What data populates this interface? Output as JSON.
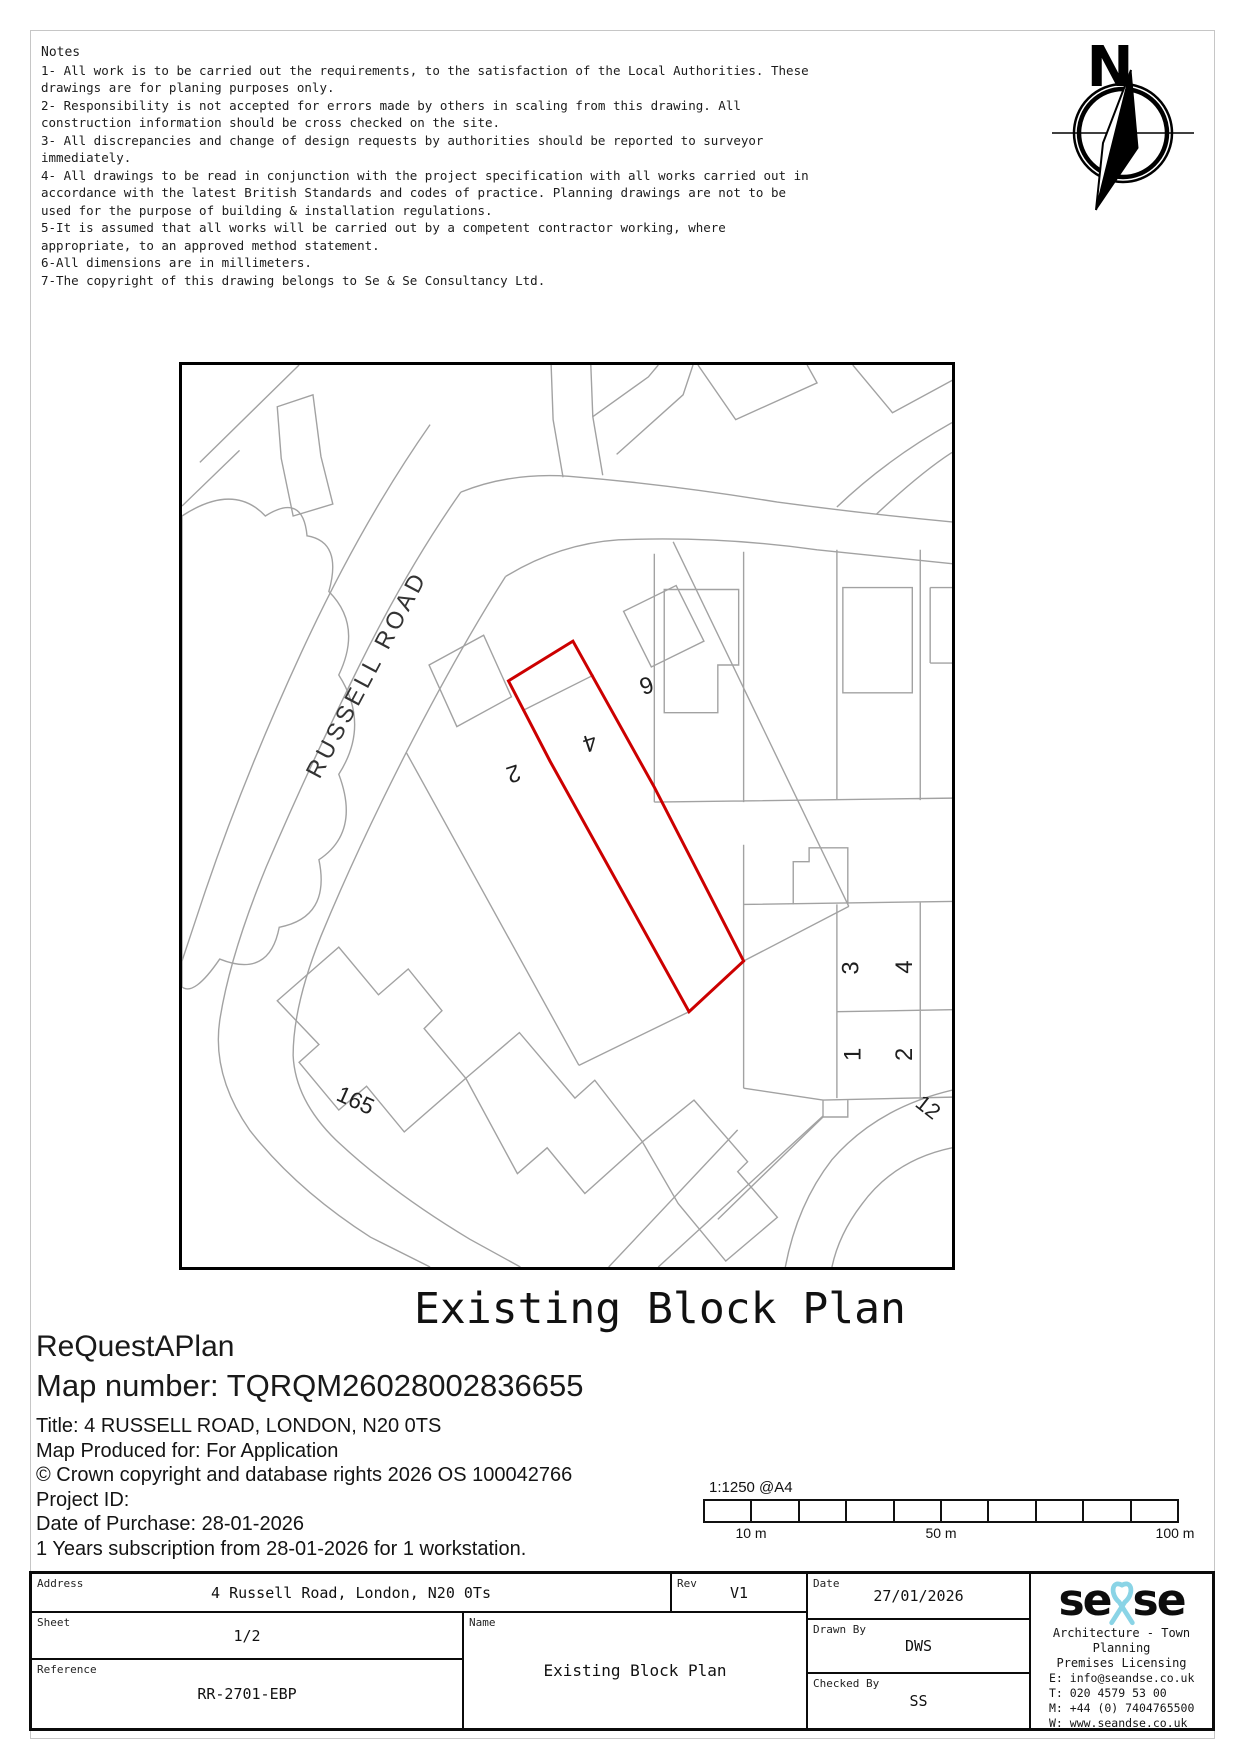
{
  "notes": {
    "title": "Notes",
    "lines": [
      "1- All work is to be carried out the requirements, to the satisfaction of the Local Authorities. These",
      "drawings are for planing purposes only.",
      "2- Responsibility is not accepted for errors made by others in scaling from this drawing. All",
      "construction information should be cross checked on the site.",
      "3- All discrepancies and change of design requests by authorities should be reported to surveyor",
      "immediately.",
      "4- All drawings to be read in conjunction with the project specification with all works carried out in",
      "accordance with the latest British Standards and codes of practice. Planning drawings are not to be",
      "used for the purpose of building & installation regulations.",
      "5-It is assumed that all works will be carried out by a competent contractor working, where",
      "appropriate, to an approved method statement.",
      "6-All dimensions are in millimeters.",
      "7-The copyright of this drawing belongs to Se & Se Consultancy Ltd."
    ]
  },
  "compass": {
    "north_label": "N"
  },
  "map": {
    "site_outline_color": "#cc0000",
    "labels": {
      "road": "RUSSELL ROAD",
      "plot_2": "2",
      "plot_4": "4",
      "plot_6": "6",
      "house_165": "165",
      "block_3": "3",
      "block_4": "4",
      "block_1": "1",
      "block_2": "2",
      "road_12": "12"
    }
  },
  "caption": {
    "drawing_title": "Existing Block Plan",
    "brand": "ReQuestAPlan",
    "map_number": "Map number: TQRQM26028002836655"
  },
  "meta_lines": [
    "Title: 4 RUSSELL ROAD, LONDON, N20 0TS",
    "Map Produced for: For Application",
    "© Crown copyright and database rights 2026 OS 100042766",
    "Project ID:",
    "Date of Purchase: 28-01-2026",
    "1 Years subscription from 28-01-2026 for 1 workstation."
  ],
  "scale_bar": {
    "scale_label": "1:1250 @A4",
    "tick_10": "10 m",
    "tick_50": "50 m",
    "tick_100": "100 m"
  },
  "title_block": {
    "address_label": "Address",
    "address_value": "4 Russell Road, London, N20 0Ts",
    "sheet_label": "Sheet",
    "sheet_value": "1/2",
    "reference_label": "Reference",
    "reference_value": "RR-2701-EBP",
    "rev_label": "Rev",
    "rev_value": "V1",
    "name_label": "Name",
    "name_value": "Existing Block Plan",
    "date_label": "Date",
    "date_value": "27/01/2026",
    "drawn_label": "Drawn By",
    "drawn_value": "DWS",
    "checked_label": "Checked By",
    "checked_value": "SS",
    "logo": {
      "part1": "se",
      "part2": "se",
      "accent": "#8ad4e6",
      "tagline1": "Architecture - Town Planning",
      "tagline2": "Premises Licensing",
      "email": "E: info@seandse.co.uk",
      "tel": "T: 020 4579 53 00",
      "mobile": "M: +44 (0) 7404765500",
      "web": "W: www.seandse.co.uk"
    }
  }
}
